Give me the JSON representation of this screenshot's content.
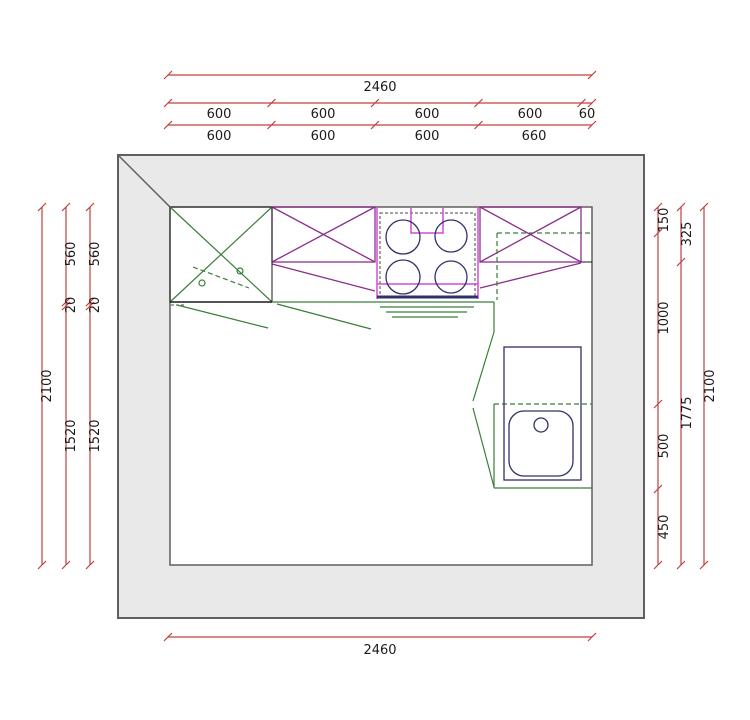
{
  "drawing_type": "kitchen-floor-plan",
  "colors": {
    "wall": "#5f5f5f",
    "wall_fill": "#e9e9e9",
    "dim": "#c2403e",
    "text": "#1a1a1a",
    "black": "#1a1a1a",
    "green": "#3a7d3a",
    "purple": "#8b2f8b",
    "magenta": "#d44ad4",
    "navy": "#30306b"
  },
  "dims": {
    "top": {
      "total": "2460",
      "row2": [
        "600",
        "600",
        "600",
        "600",
        "60"
      ],
      "row3": [
        "600",
        "600",
        "600",
        "660"
      ]
    },
    "bottom": {
      "total": "2460"
    },
    "left": {
      "overall": "2100",
      "line_mid": [
        "560",
        "20",
        "1520"
      ],
      "line_inner": [
        "560",
        "20",
        "1520"
      ]
    },
    "right": {
      "line_inner": [
        "150",
        "1000",
        "500",
        "450"
      ],
      "line_mid": [
        "325",
        "1775"
      ],
      "overall": "2100"
    }
  }
}
